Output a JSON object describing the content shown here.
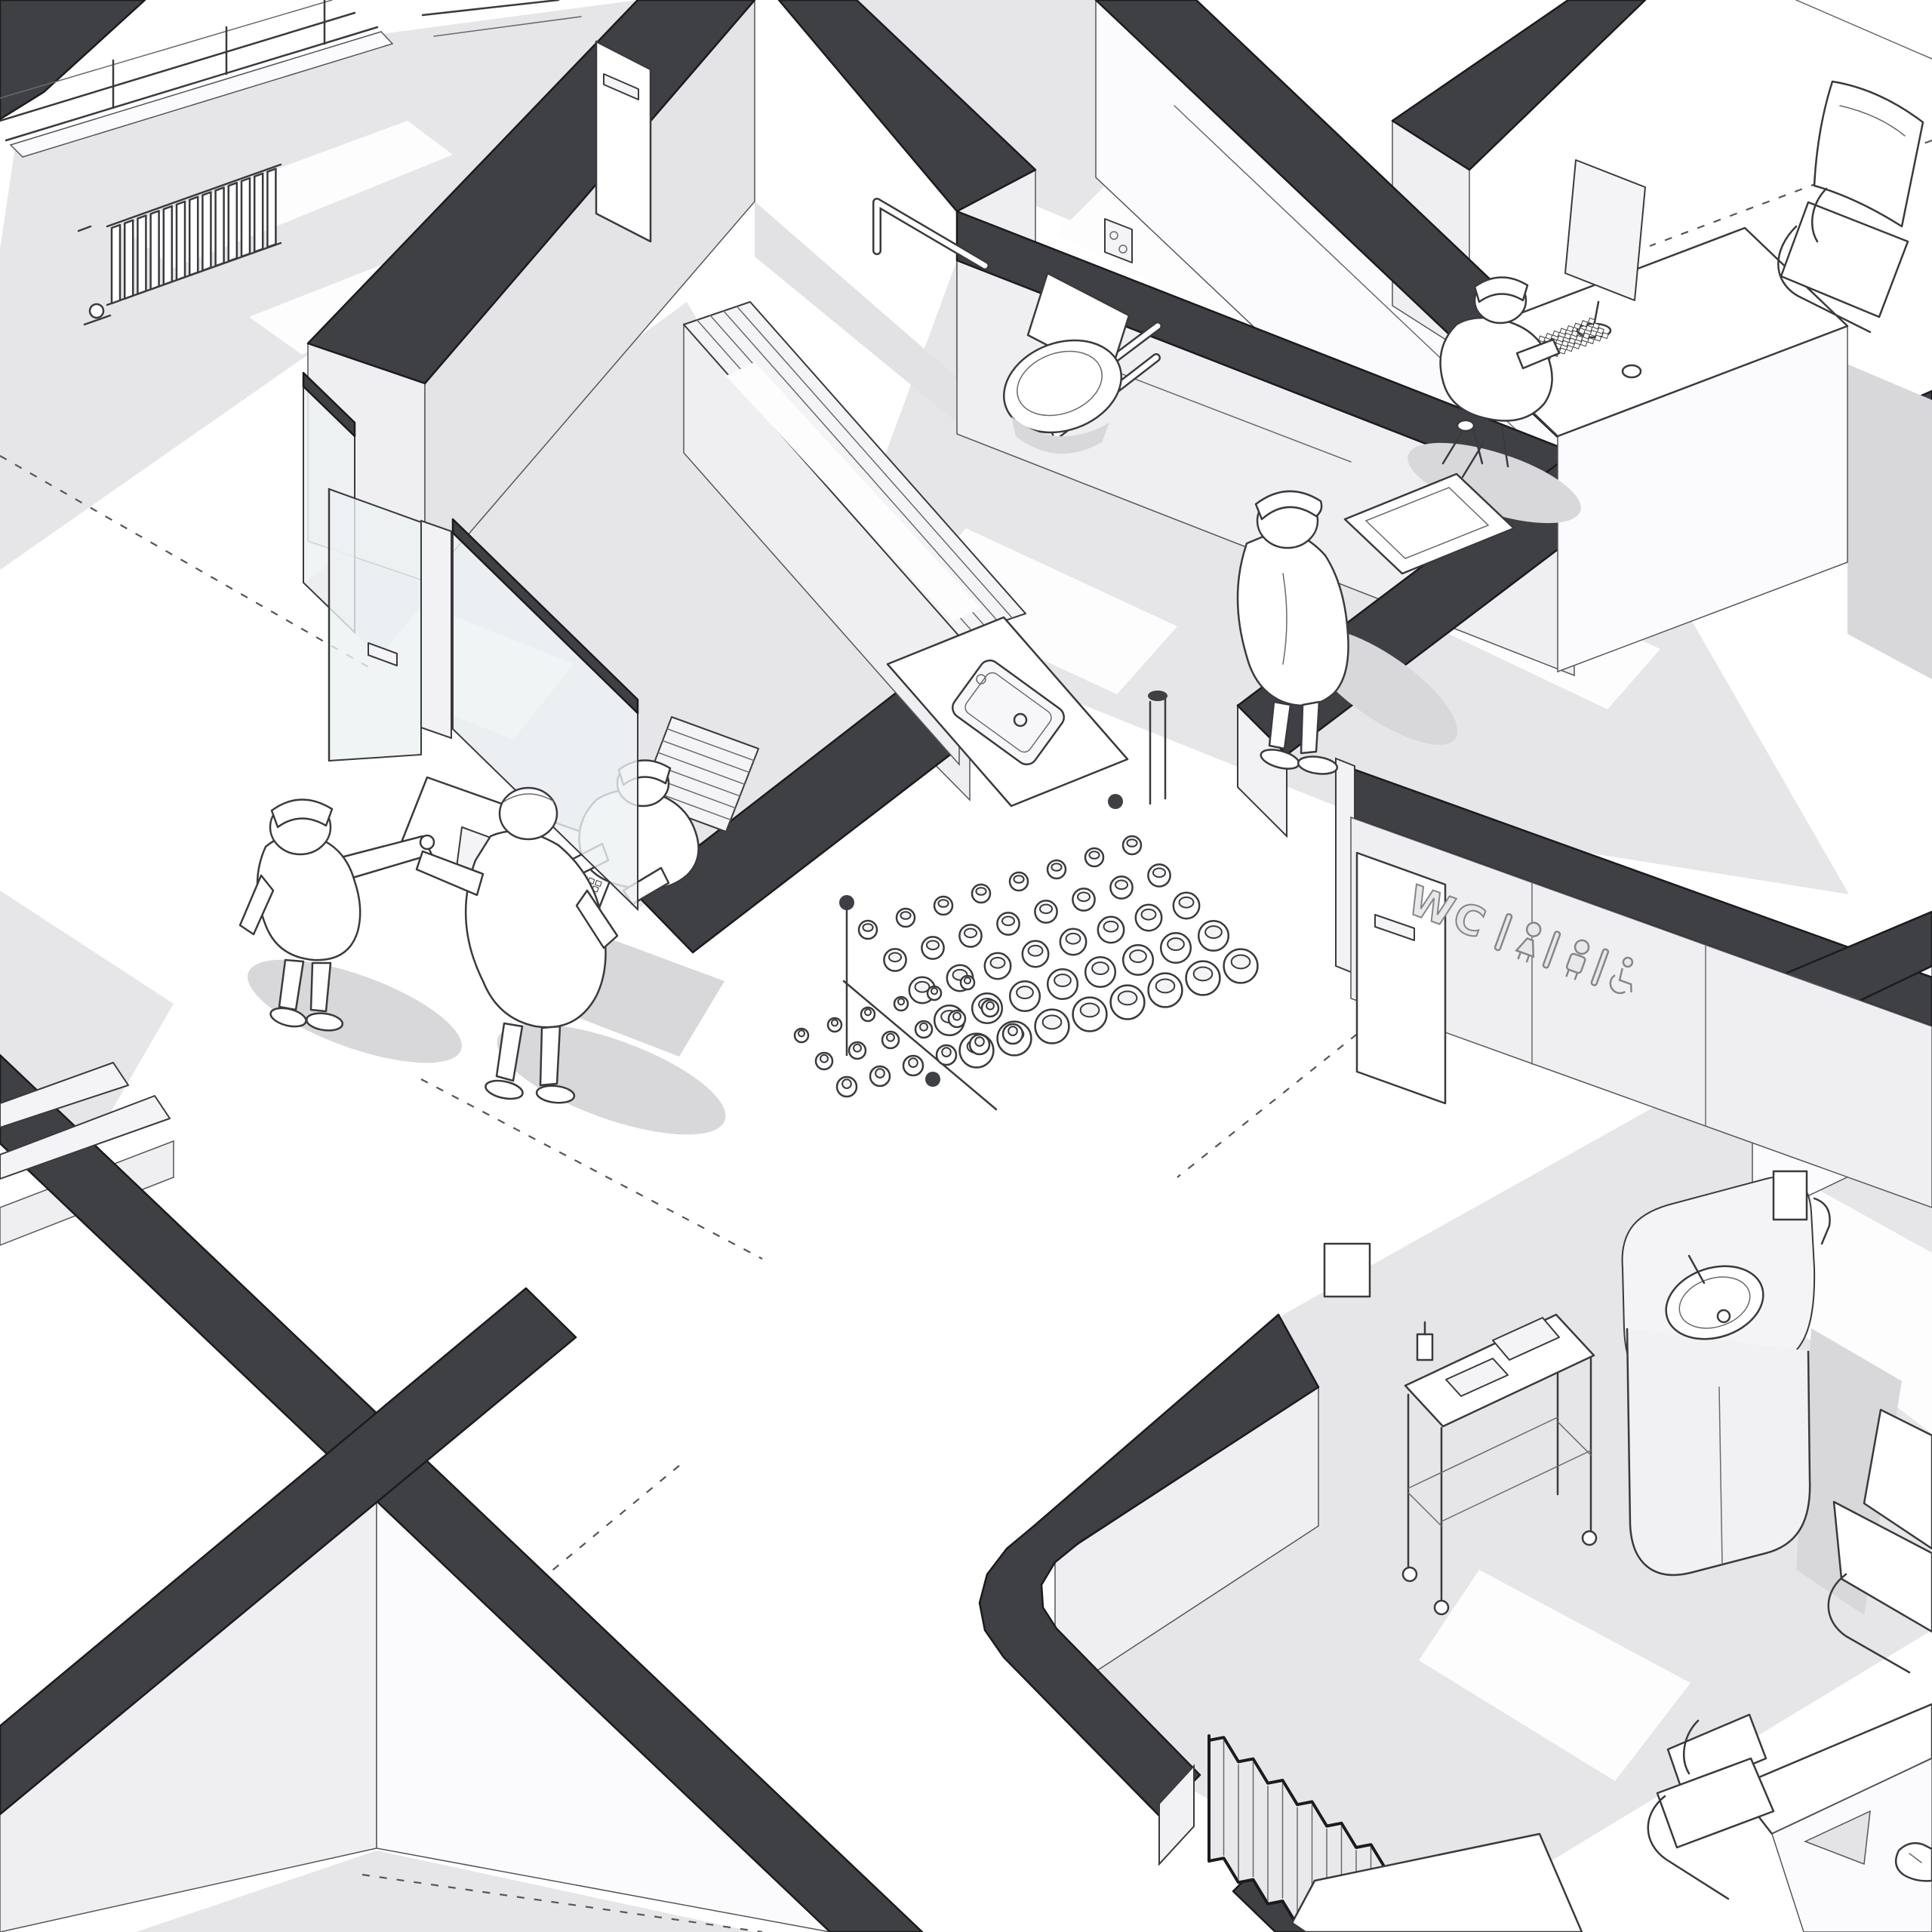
{
  "scene": {
    "type": "axonometric-cutaway-floor-plan",
    "setting": "clinic interior, monochrome architectural line drawing",
    "signage": {
      "wc_label": "WC",
      "icons": [
        "divider-bar",
        "female-icon",
        "divider-bar",
        "male-icon",
        "divider-bar",
        "wheelchair-icon"
      ]
    },
    "palette": {
      "background": "#ffffff",
      "wall_cut_top": "#3f4044",
      "wall_outline": "#1b1b1e",
      "floor": "#e6e6e9",
      "shadow": "#d8d8db",
      "wall_face": "#efeff1",
      "line": "#3a3a3e",
      "glass": "#eef1f3"
    },
    "objects": [
      "window-wall-with-radiator",
      "accessible-toilet-with-grab-bars",
      "flush-plate",
      "consultation-desk-with-monitor-and-keyboard",
      "visitor-cantilever-chair",
      "reception-desk-with-monitor-and-keyboard",
      "open-shelving-unit",
      "glass-partition-door",
      "storage-counter-with-inset-sink",
      "bottle-rack-with-jars",
      "wall-hung-wash-basin",
      "wc-sign-wall-with-door",
      "rounded-sink-cabinet",
      "medical-trolley-cart",
      "privacy-curtain",
      "paper-towel-dispenser",
      "corner-desk-with-chair",
      "section-trace-dashed-lines"
    ],
    "figures": [
      "doctor-at-desk",
      "receptionist-at-keyboard",
      "nurse-opening-glass-door",
      "patient-in-corridor",
      "person-at-wash-basin",
      "hand-at-corner-desk"
    ]
  }
}
